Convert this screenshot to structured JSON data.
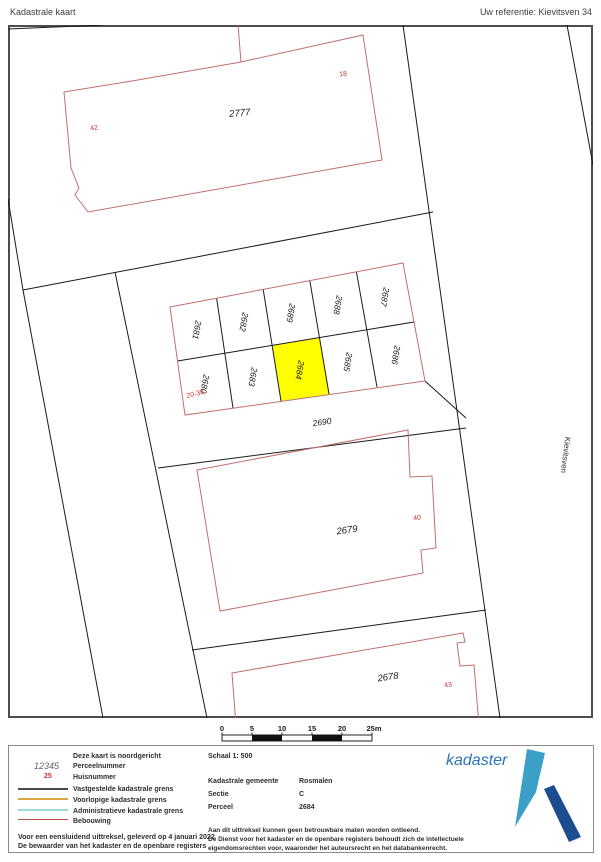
{
  "header": {
    "title": "Kadastrale kaart",
    "reference": "Uw referentie: Kievitsven 34"
  },
  "map": {
    "street_label": "Kievitsven",
    "parcels": [
      "2777",
      "2681",
      "2682",
      "2689",
      "2688",
      "2687",
      "2680",
      "2683",
      "2684",
      "2685",
      "2686",
      "2690",
      "2679",
      "2678"
    ],
    "house_numbers": [
      "42",
      "18",
      "20-38",
      "40",
      "43"
    ],
    "highlighted_parcel": "2684"
  },
  "scalebar": {
    "ticks": [
      "0",
      "5",
      "10",
      "15",
      "20",
      "25m"
    ]
  },
  "legend": {
    "north_note": "Deze kaart is noordgericht",
    "sample_parcel_number": "12345",
    "sample_parcel_label": "Perceelnummer",
    "sample_house_number": "25",
    "sample_house_label": "Huisnummer",
    "line_items": [
      {
        "label": "Vastgestelde kadastrale grens",
        "color": "#4a4a4a"
      },
      {
        "label": "Voorlopige kadastrale grens",
        "color": "#d9a441"
      },
      {
        "label": "Administratieve kadastrale grens",
        "color": "#9adbd9"
      },
      {
        "label": "Bebouwing",
        "color": "#c0504d"
      }
    ],
    "footer_line1": "Voor een eensluidend uittreksel, geleverd op 4 januari 2022",
    "footer_line2": "De bewaarder van het kadaster en de openbare registers"
  },
  "details": {
    "scale_label": "Schaal 1: 500",
    "rows": [
      {
        "label": "Kadastrale gemeente",
        "value": "Rosmalen"
      },
      {
        "label": "Sectie",
        "value": "C"
      },
      {
        "label": "Perceel",
        "value": "2684"
      }
    ],
    "disclaimer1": "Aan dit uittreksel kunnen geen betrouwbare maten worden ontleend.",
    "disclaimer2": "De Dienst voor het kadaster en de openbare registers behoudt zich de intellectuele eigendomsrechten voor, waaronder het auteursrecht en het databankenrecht."
  },
  "logo": {
    "text": "kadaster"
  },
  "colors": {
    "highlight": "#ffff00",
    "parcel_boundary": "#1a1a1a",
    "building_outline": "#c0706e",
    "house_number": "#cc3333",
    "logo_light_blue": "#3aa0c8",
    "logo_dark_blue": "#1b4d8f",
    "logo_text_blue": "#2d74b5"
  }
}
